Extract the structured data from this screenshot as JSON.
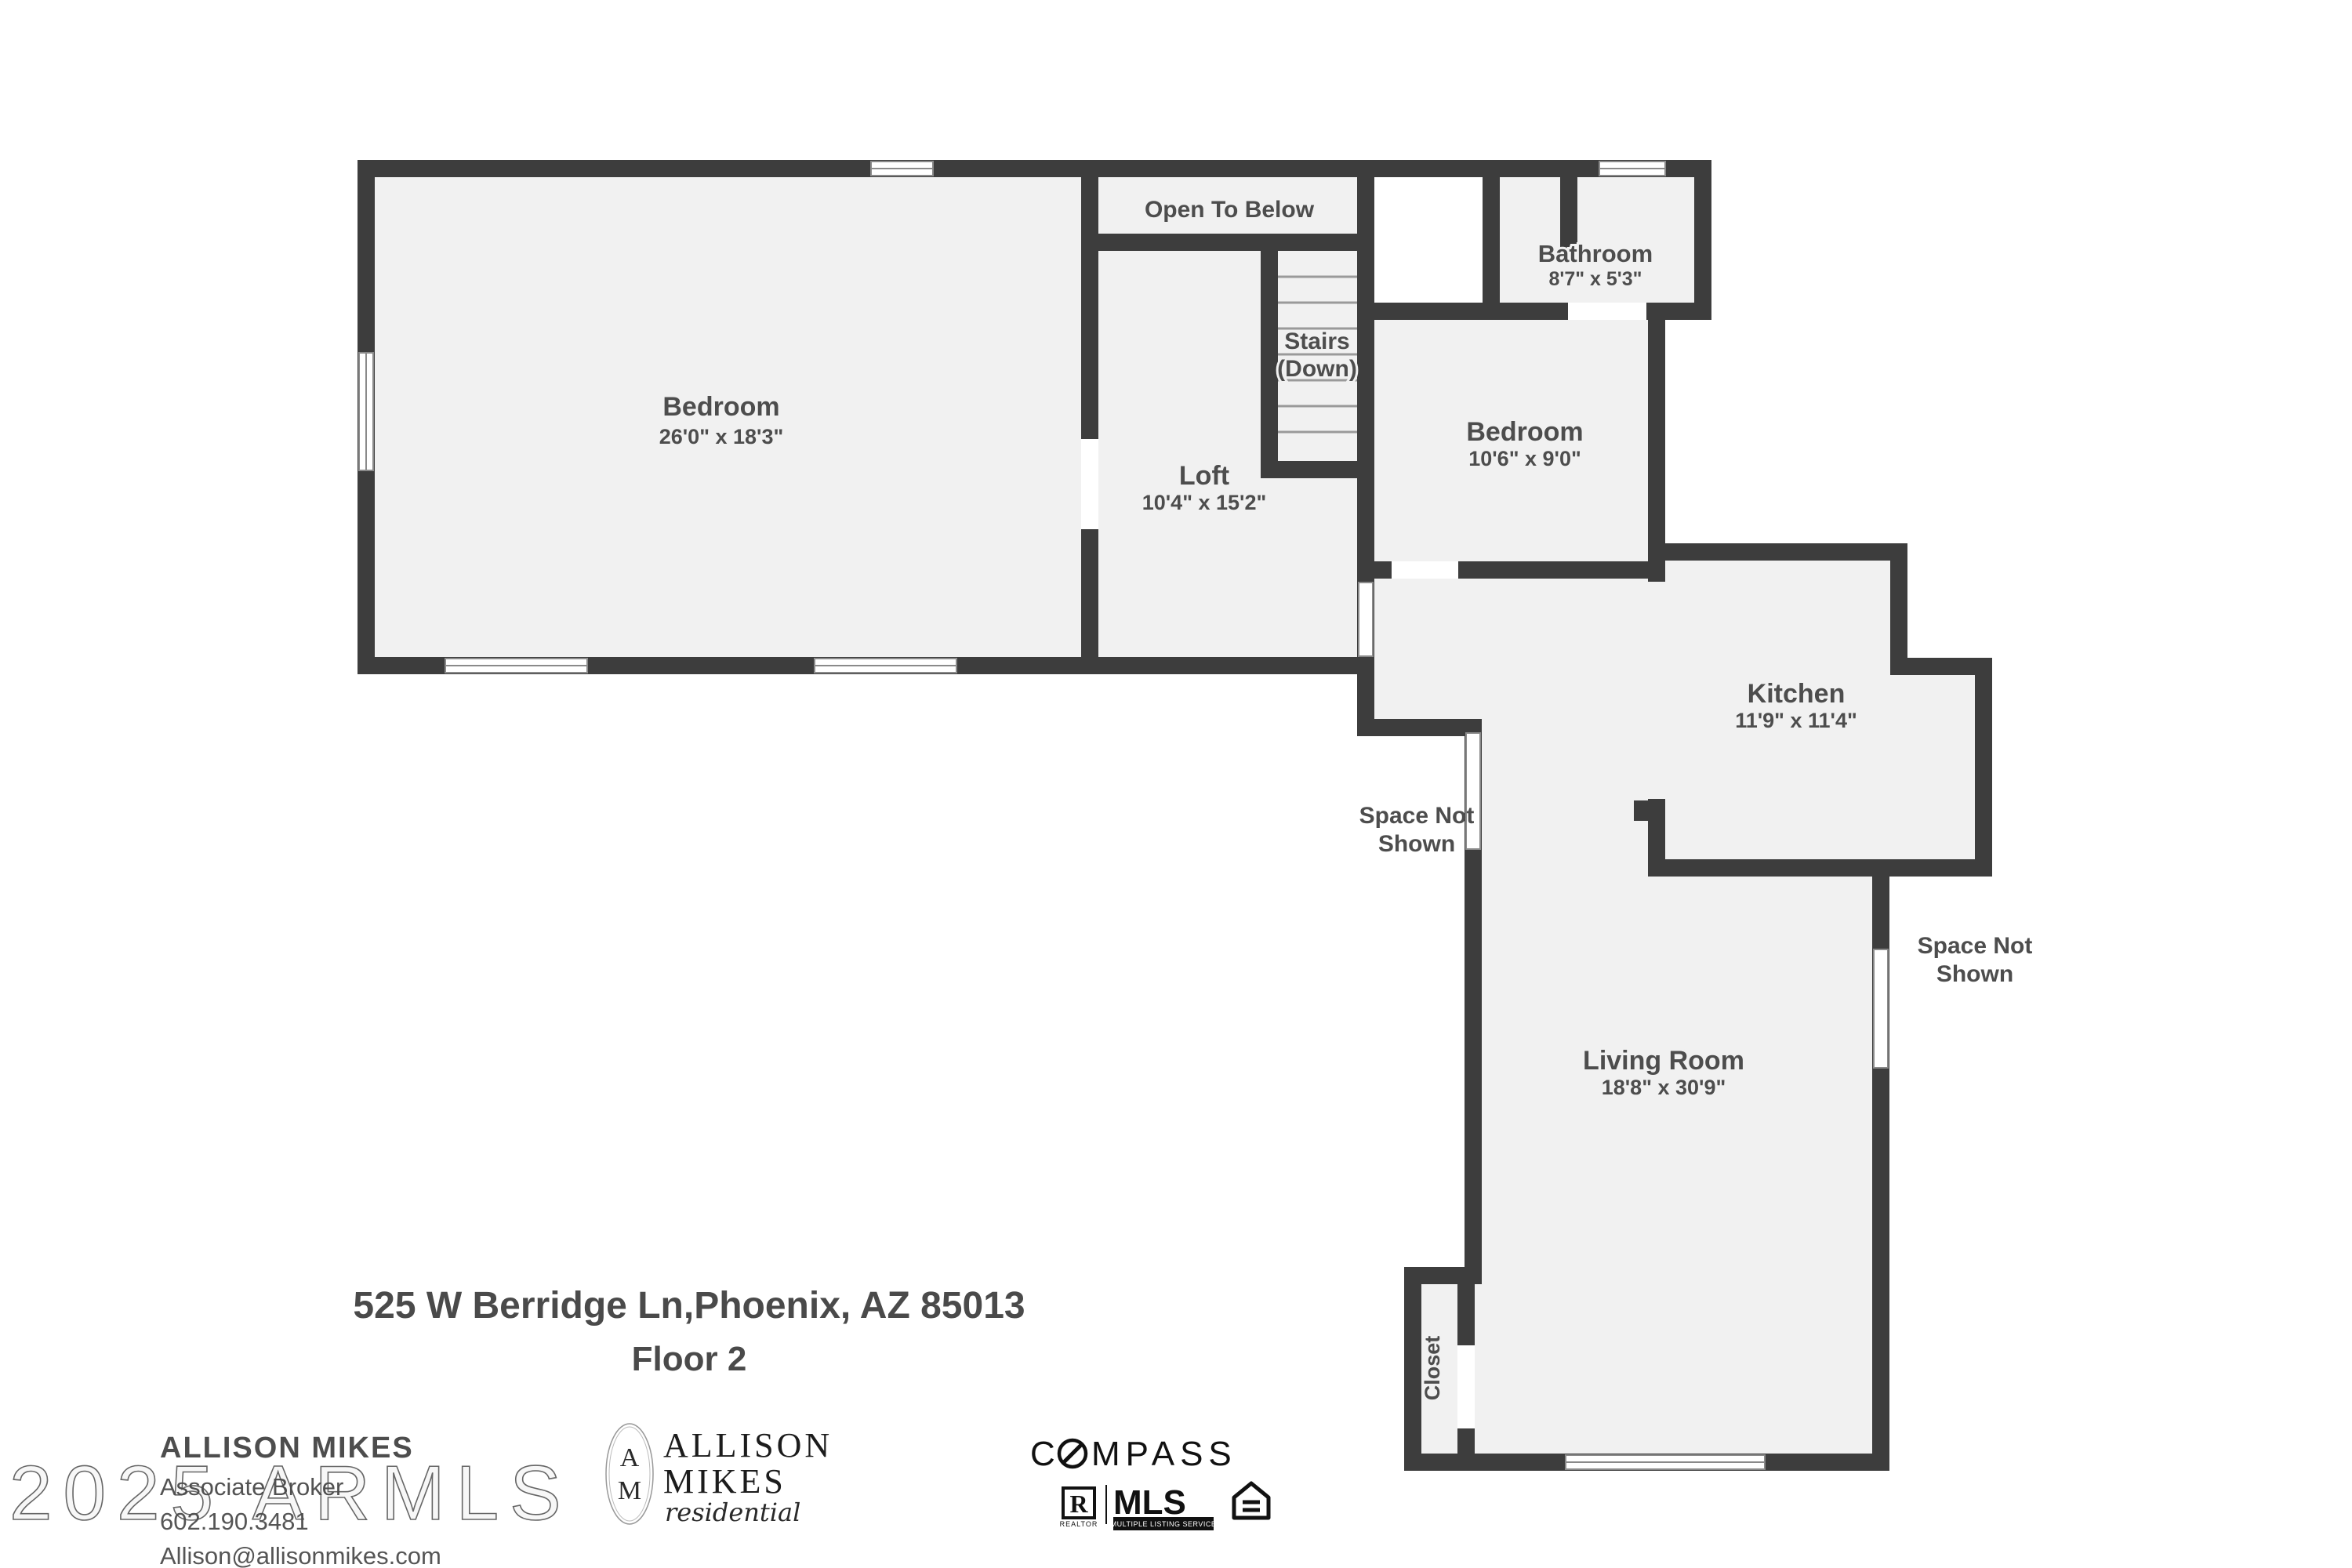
{
  "colors": {
    "wall": "#3d3d3d",
    "floor": "#f1f1f1",
    "label": "#4d4d4d",
    "window_frame": "#8a8a8a",
    "background": "#ffffff"
  },
  "plan": {
    "rooms": {
      "bedroom_main": {
        "name": "Bedroom",
        "dims": "26'0\" x 18'3\""
      },
      "open_to_below": {
        "name": "Open To Below"
      },
      "stairs": {
        "name": "Stairs",
        "sub": "(Down)"
      },
      "loft": {
        "name": "Loft",
        "dims": "10'4\" x 15'2\""
      },
      "bathroom": {
        "name": "Bathroom",
        "dims": "8'7\" x 5'3\""
      },
      "bedroom_second": {
        "name": "Bedroom",
        "dims": "10'6\" x 9'0\""
      },
      "kitchen": {
        "name": "Kitchen",
        "dims": "11'9\" x 11'4\""
      },
      "living_room": {
        "name": "Living Room",
        "dims": "18'8\" x 30'9\""
      },
      "closet": {
        "name": "Closet"
      },
      "space_not_shown_left": {
        "line1": "Space Not",
        "line2": "Shown"
      },
      "space_not_shown_right": {
        "line1": "Space Not",
        "line2": "Shown"
      }
    }
  },
  "address": {
    "line1": "525 W Berridge Ln,Phoenix, AZ 85013",
    "line2": "Floor 2"
  },
  "agent": {
    "name": "ALLISON MIKES",
    "title": "Associate Broker",
    "phone": "602.190.3481",
    "email": "Allison@allisonmikes.com"
  },
  "brand": {
    "monogram_top": "A",
    "monogram_bottom": "M",
    "line1": "ALLISON",
    "line2": "MIKES",
    "tagline": "residential"
  },
  "compass": {
    "prefix": "C",
    "suffix": "MPASS"
  },
  "mls": {
    "realtor_r": "R",
    "realtor_label": "REALTOR",
    "mls": "MLS",
    "mls_sub": "MULTIPLE LISTING SERVICE"
  },
  "watermark": {
    "text": "2025 ARMLS"
  }
}
